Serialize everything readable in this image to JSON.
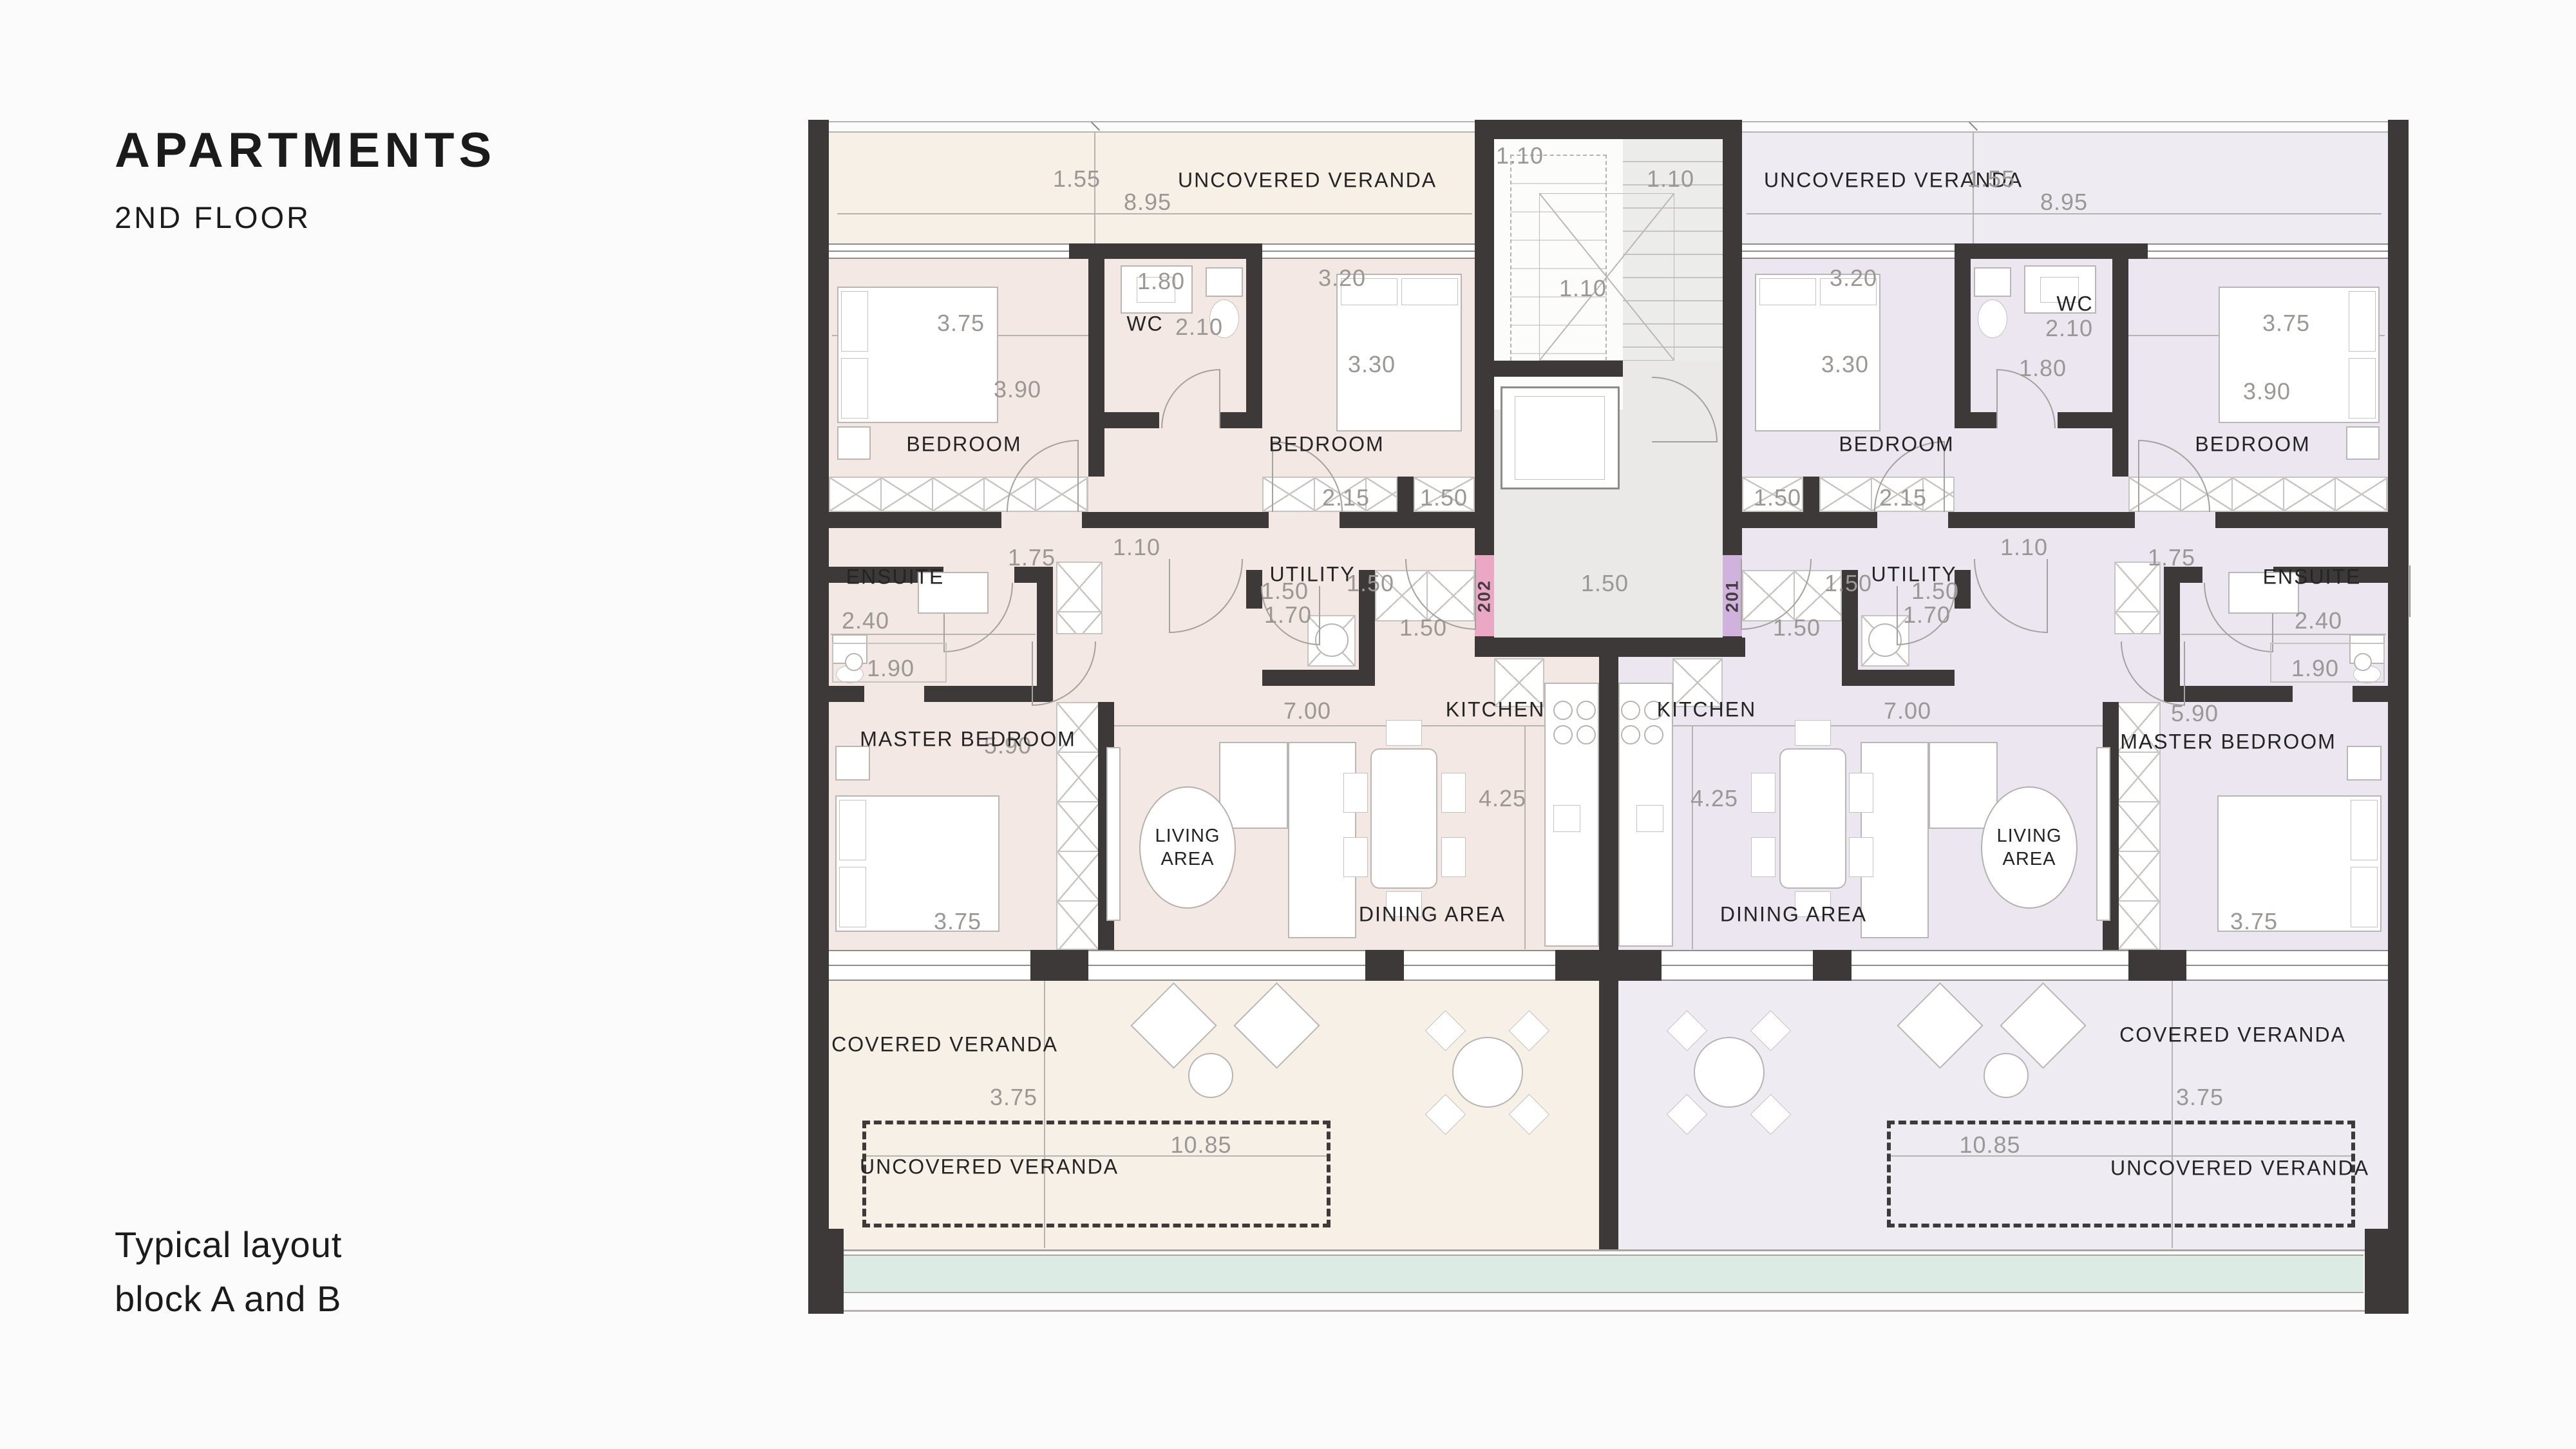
{
  "page": {
    "title": "APARTMENTS",
    "subtitle": "2ND FLOOR",
    "note_line1": "Typical layout",
    "note_line2": "block A and B"
  },
  "core": {
    "dim_top": "1.10",
    "dim_right": "1.10",
    "dim_bottom": "1.10",
    "dim_lobby": "1.50",
    "tag_left": "202",
    "tag_right": "201"
  },
  "unit_a": {
    "labels": {
      "veranda_top": "UNCOVERED VERANDA",
      "bedroom_1": "BEDROOM",
      "wc": "WC",
      "bedroom_2": "BEDROOM",
      "ensuite": "ENSUITE",
      "utility": "UTILITY",
      "kitchen": "KITCHEN",
      "living_line1": "LIVING",
      "living_line2": "AREA",
      "dining": "DINING AREA",
      "master": "MASTER BEDROOM",
      "veranda_covered": "COVERED VERANDA",
      "veranda_uncovered": "UNCOVERED VERANDA"
    },
    "dims": {
      "veranda_h": "1.55",
      "veranda_w": "8.95",
      "bed1_w": "3.75",
      "bed1_d": "3.90",
      "wc_top": "1.80",
      "wc_w": "2.10",
      "bed2_w": "3.20",
      "bed2_d": "3.30",
      "ward_a": "2.15",
      "ward_b": "1.50",
      "hall": "1.10",
      "ward_c": "1.75",
      "ens_w": "2.40",
      "ens_d": "1.90",
      "util_a": "1.50",
      "util_b": "1.50",
      "util_c": "1.70",
      "kit_side": "1.50",
      "open_w": "7.00",
      "open_d": "4.25",
      "master_l": "5.90",
      "master_w": "3.75",
      "veranda_cov_d": "3.75",
      "veranda_unc_w": "10.85"
    }
  },
  "unit_b": {
    "labels": {
      "veranda_top": "UNCOVERED VERANDA",
      "bedroom_1": "BEDROOM",
      "wc": "WC",
      "bedroom_2": "BEDROOM",
      "ensuite": "ENSUITE",
      "utility": "UTILITY",
      "kitchen": "KITCHEN",
      "living_line1": "LIVING",
      "living_line2": "AREA",
      "dining": "DINING AREA",
      "master": "MASTER BEDROOM",
      "veranda_covered": "COVERED VERANDA",
      "veranda_uncovered": "UNCOVERED VERANDA"
    },
    "dims": {
      "veranda_h": "1.55",
      "veranda_w": "8.95",
      "bed1_w": "3.75",
      "bed1_d": "3.90",
      "wc_top": "1.80",
      "wc_w": "2.10",
      "bed2_w": "3.20",
      "bed2_d": "3.30",
      "ward_a": "2.15",
      "ward_b": "1.50",
      "hall": "1.10",
      "ward_c": "1.75",
      "ens_w": "2.40",
      "ens_d": "1.90",
      "util_a": "1.50",
      "util_b": "1.50",
      "util_c": "1.70",
      "kit_side": "1.50",
      "open_w": "7.00",
      "open_d": "4.25",
      "master_l": "5.90",
      "master_w": "3.75",
      "veranda_cov_d": "3.75",
      "veranda_unc_w": "10.85"
    }
  }
}
